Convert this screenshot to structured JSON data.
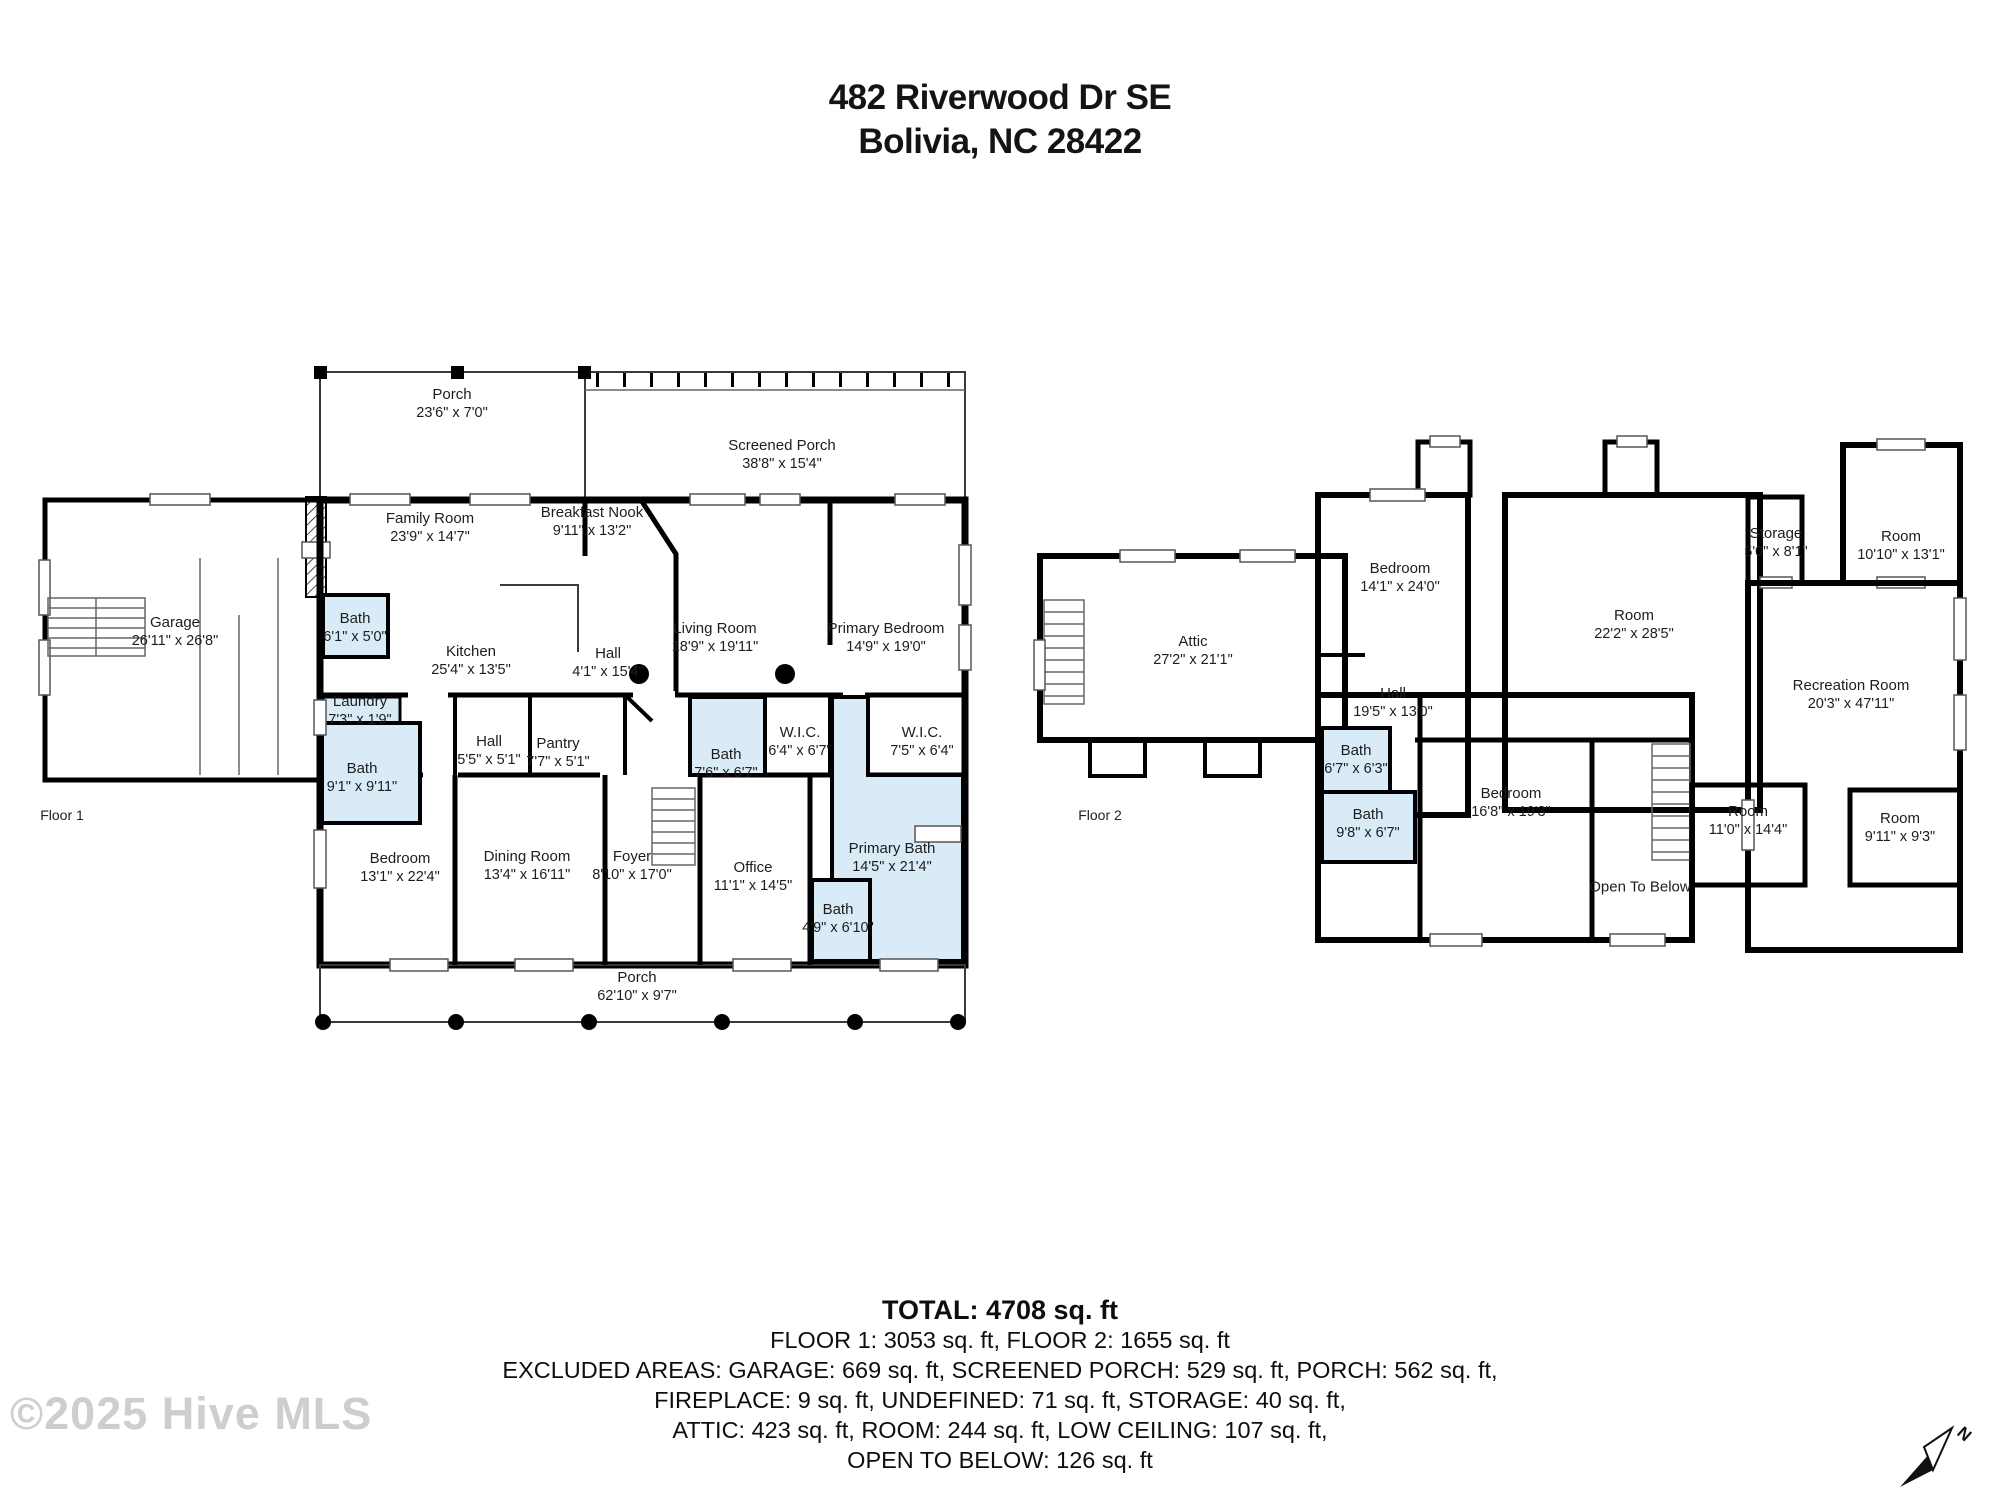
{
  "header": {
    "address_line1": "482 Riverwood Dr SE",
    "address_line2": "Bolivia, NC 28422"
  },
  "floor1": {
    "label": "Floor 1",
    "rooms": [
      {
        "name": "Porch",
        "dims": "23'6\" x 7'0\""
      },
      {
        "name": "Screened Porch",
        "dims": "38'8\" x 15'4\""
      },
      {
        "name": "Garage",
        "dims": "26'11\" x 26'8\""
      },
      {
        "name": "Family Room",
        "dims": "23'9\" x 14'7\""
      },
      {
        "name": "Breakfast Nook",
        "dims": "9'11\" x 13'2\""
      },
      {
        "name": "Bath",
        "dims": "6'1\" x 5'0\""
      },
      {
        "name": "Kitchen",
        "dims": "25'4\" x 13'5\""
      },
      {
        "name": "Hall",
        "dims": "4'1\" x 15'4\""
      },
      {
        "name": "Living Room",
        "dims": "18'9\" x 19'11\""
      },
      {
        "name": "Primary Bedroom",
        "dims": "14'9\" x 19'0\""
      },
      {
        "name": "Laundry",
        "dims": "7'3\" x 1'9\""
      },
      {
        "name": "Hall",
        "dims": "5'5\" x 5'1\""
      },
      {
        "name": "Pantry",
        "dims": "7'7\" x 5'1\""
      },
      {
        "name": "Bath",
        "dims": "7'6\" x 6'7\""
      },
      {
        "name": "W.I.C.",
        "dims": "6'4\" x 6'7\""
      },
      {
        "name": "W.I.C.",
        "dims": "7'5\" x 6'4\""
      },
      {
        "name": "Bath",
        "dims": "9'1\" x 9'11\""
      },
      {
        "name": "Bedroom",
        "dims": "13'1\" x 22'4\""
      },
      {
        "name": "Dining Room",
        "dims": "13'4\" x 16'11\""
      },
      {
        "name": "Foyer",
        "dims": "8'10\" x 17'0\""
      },
      {
        "name": "Office",
        "dims": "11'1\" x 14'5\""
      },
      {
        "name": "Primary Bath",
        "dims": "14'5\" x 21'4\""
      },
      {
        "name": "Bath",
        "dims": "4'9\" x 6'10\""
      },
      {
        "name": "Porch",
        "dims": "62'10\" x 9'7\""
      }
    ]
  },
  "floor2": {
    "label": "Floor 2",
    "rooms": [
      {
        "name": "Attic",
        "dims": "27'2\" x 21'1\""
      },
      {
        "name": "Bedroom",
        "dims": "14'1\" x 24'0\""
      },
      {
        "name": "Hall",
        "dims": "19'5\" x 13'0\""
      },
      {
        "name": "Room",
        "dims": "22'2\" x 28'5\""
      },
      {
        "name": "Storage",
        "dims": "5'0\" x 8'1\""
      },
      {
        "name": "Room",
        "dims": "10'10\" x 13'1\""
      },
      {
        "name": "Recreation Room",
        "dims": "20'3\" x 47'11\""
      },
      {
        "name": "Bath",
        "dims": "6'7\" x 6'3\""
      },
      {
        "name": "Bath",
        "dims": "9'8\" x 6'7\""
      },
      {
        "name": "Bedroom",
        "dims": "16'8\" x 19'3\""
      },
      {
        "name": "Open To Below",
        "dims": ""
      },
      {
        "name": "Room",
        "dims": "11'0\" x 14'4\""
      },
      {
        "name": "Room",
        "dims": "9'11\" x 9'3\""
      }
    ]
  },
  "summary": {
    "total": "TOTAL:  4708  sq. ft",
    "line1": "FLOOR 1: 3053  sq. ft, FLOOR 2: 1655  sq. ft",
    "line2": "EXCLUDED AREAS: GARAGE: 669 sq. ft, SCREENED PORCH: 529 sq. ft, PORCH: 562 sq. ft,",
    "line3": "FIREPLACE: 9 sq. ft, UNDEFINED: 71 sq. ft, STORAGE: 40 sq. ft,",
    "line4": "ATTIC: 423 sq. ft, ROOM: 244 sq. ft, LOW CEILING: 107 sq. ft,",
    "line5": "OPEN TO BELOW: 126 sq. ft",
    "disclaimer": "Interior Dimensions Are Approximate. Actual May Vary. Gla Measured Per Ansi Guidelines."
  },
  "watermark": "©2025 Hive MLS",
  "compass": {
    "label": "N"
  },
  "colors": {
    "bath_fill": "#d9ebf7",
    "wall": "#000000"
  }
}
